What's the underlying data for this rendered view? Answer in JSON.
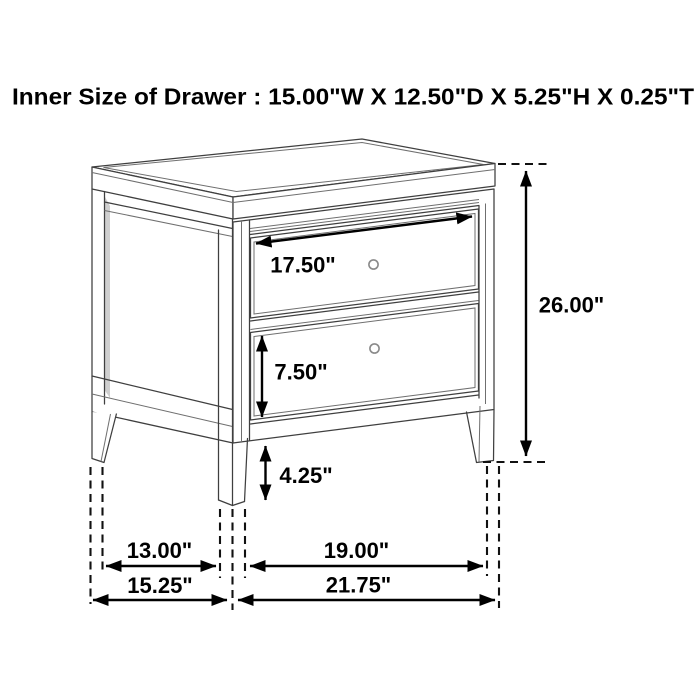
{
  "title": "Inner Size of Drawer : 15.00\"W X 12.50\"D X 5.25\"H X 0.25\"T",
  "diagram": {
    "subject": "two-drawer nightstand dimension line drawing",
    "dimensions": {
      "drawer_width": "17.50\"",
      "overall_height": "26.00\"",
      "lower_drawer_height": "7.50\"",
      "leg_height": "4.25\"",
      "depth_inner": "13.00\"",
      "depth_overall": "15.25\"",
      "width_inner": "19.00\"",
      "width_overall": "21.75\""
    },
    "colors": {
      "furniture_line": "#3f3f3f",
      "dimension_ink": "#000000",
      "background": "#ffffff"
    }
  }
}
